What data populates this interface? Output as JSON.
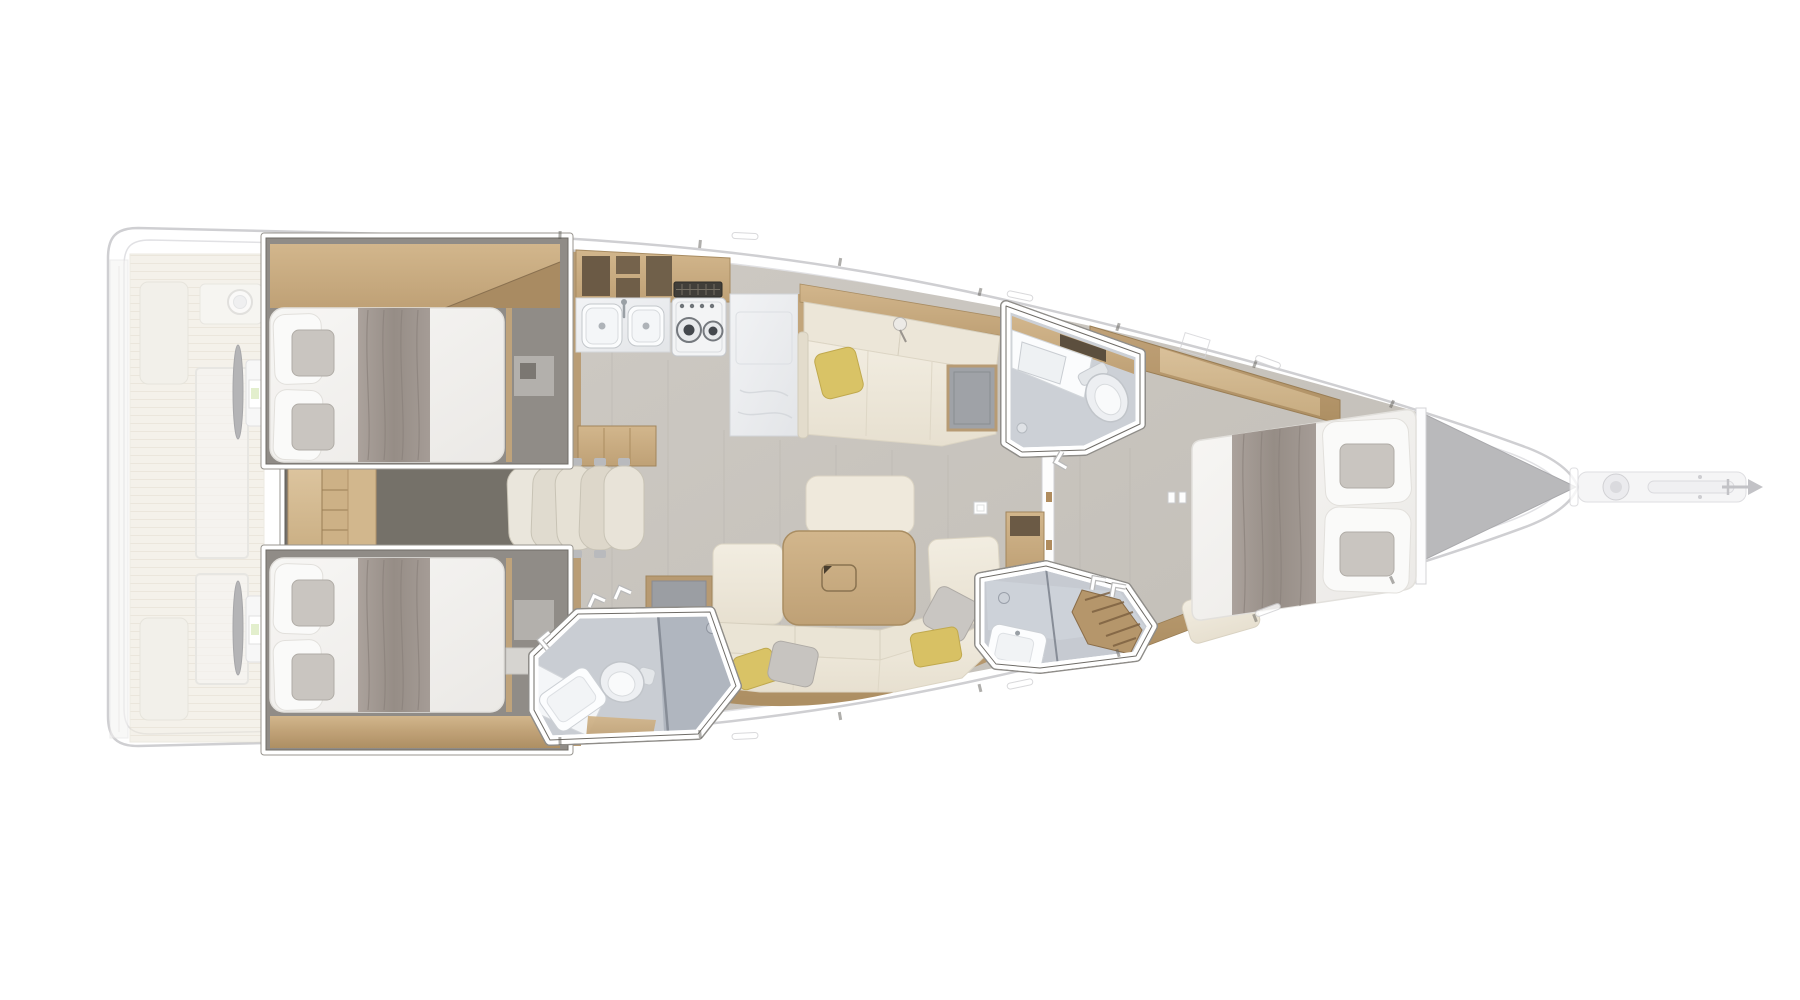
{
  "page": {
    "kind": "yacht-interior-floor-plan",
    "view": "top-down-deck-plan",
    "orientation": "bow-right",
    "visible_text": "none"
  },
  "counts": {
    "double_berth_cabins": 3,
    "wet_rooms": 3,
    "toilets": 2,
    "showers": 2,
    "helm_stations": 2,
    "stowed_chairs": 5,
    "galley_sink_basins": 2,
    "stove_burners": 2,
    "accent_pillows_yellow": 3
  },
  "rooms": [
    {
      "id": "cockpit",
      "label": "Cockpit with twin helm stations (ghosted)"
    },
    {
      "id": "aft-cabin-port",
      "label": "Aft port cabin - double berth"
    },
    {
      "id": "aft-cabin-starboard",
      "label": "Aft starboard cabin - double berth"
    },
    {
      "id": "midship-wardrobe",
      "label": "Midship wardrobe with stowed chairs"
    },
    {
      "id": "galley",
      "label": "Galley - twin sinks, stove, marble island"
    },
    {
      "id": "upper-settee",
      "label": "Starboard settee with chart seat"
    },
    {
      "id": "salon",
      "label": "Salon - dining table, sofa, ottoman"
    },
    {
      "id": "head-aft",
      "label": "Aft head - sink, toilet, shower"
    },
    {
      "id": "head-forward-starboard",
      "label": "Forward head - vanity and toilet"
    },
    {
      "id": "head-forward-port",
      "label": "Forward shower room with teak bench"
    },
    {
      "id": "forward-cabin",
      "label": "Forward owner cabin - double berth"
    },
    {
      "id": "bow",
      "label": "Bow - anchor windlass and roller (ghosted)"
    }
  ],
  "palette": {
    "hull_outline": "#cfcfd2",
    "hull_fill": "#ffffff",
    "floor_main": "#c9c5bf",
    "cabin_floor_dark": "#908c87",
    "wood_light": "#d2b68c",
    "wood_mid": "#b2946a",
    "marble": "#eef0f2",
    "upholstery_cream": "#f0ebdf",
    "bedding_white": "#f5f4f2",
    "blanket_gray": "#a09790",
    "pillow_accent_yellow": "#d9c366",
    "bathroom_floor": "#ccd0d6",
    "shower_glass_gray": "#aab0ba",
    "forepeak_gray": "#b9b9bb",
    "teak_deck": "#ece7da"
  }
}
